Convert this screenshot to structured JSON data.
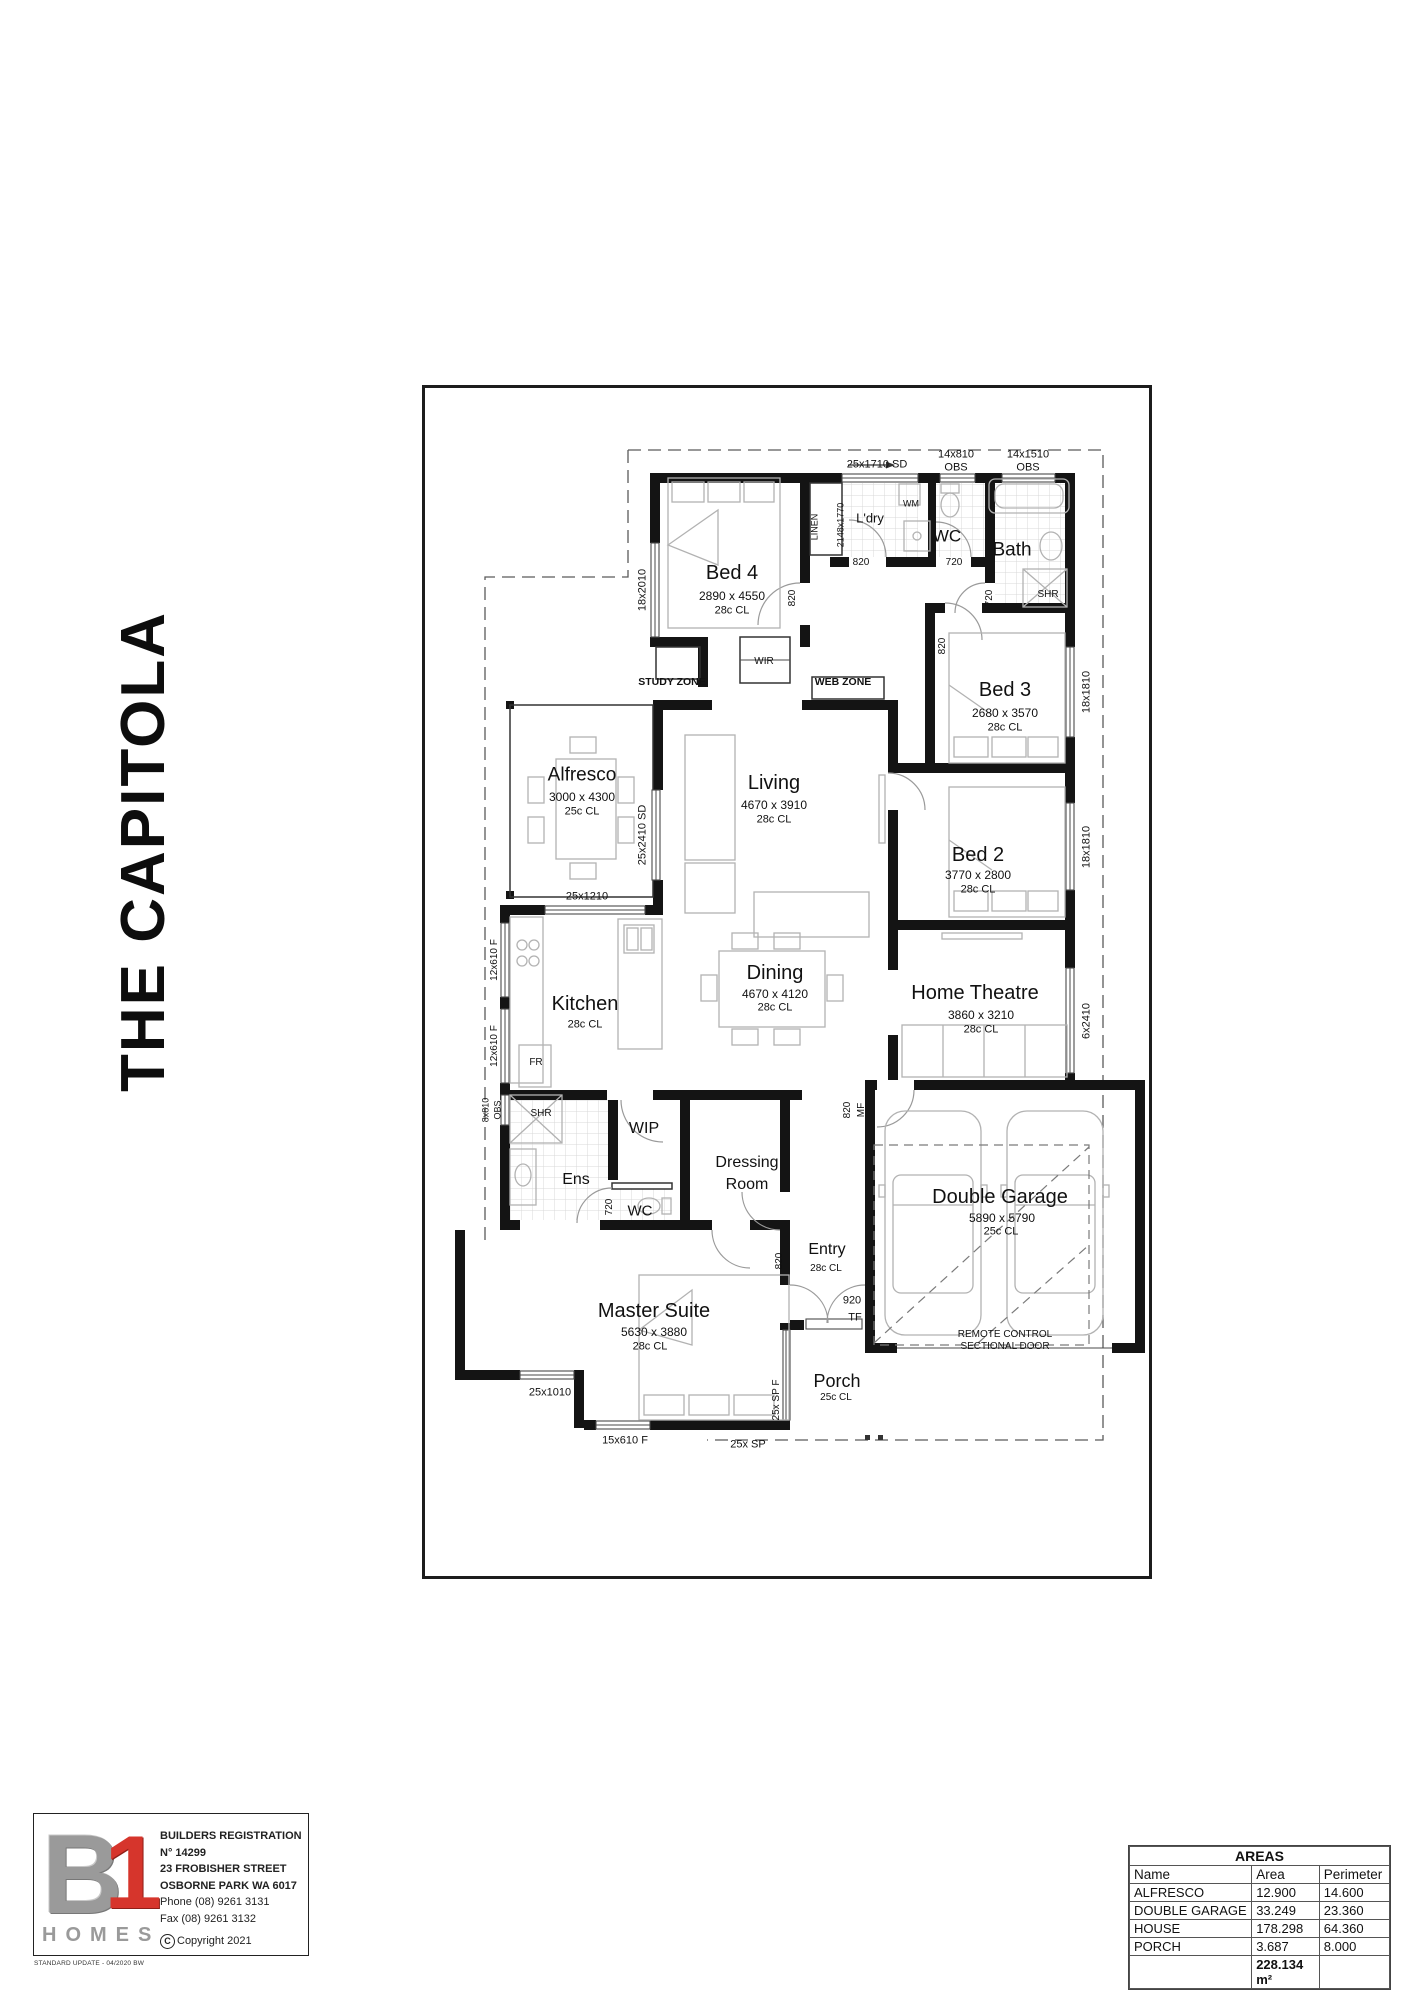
{
  "title": "THE CAPITOLA",
  "plan": {
    "rooms": {
      "bed4": {
        "name": "Bed 4",
        "dims": "2890 x 4550",
        "ceil": "28c CL"
      },
      "ldry": {
        "name": "L'dry"
      },
      "wc_top": {
        "name": "WC"
      },
      "bath": {
        "name": "Bath"
      },
      "bed3": {
        "name": "Bed 3",
        "dims": "2680 x 3570",
        "ceil": "28c CL"
      },
      "bed2": {
        "name": "Bed 2",
        "dims": "3770 x 2800",
        "ceil": "28c CL"
      },
      "theatre": {
        "name": "Home Theatre",
        "dims": "3860 x 3210",
        "ceil": "28c CL"
      },
      "alfresco": {
        "name": "Alfresco",
        "dims": "3000 x 4300",
        "ceil": "25c CL"
      },
      "living": {
        "name": "Living",
        "dims": "4670 x 3910",
        "ceil": "28c CL"
      },
      "kitchen": {
        "name": "Kitchen",
        "ceil": "28c CL"
      },
      "dining": {
        "name": "Dining",
        "dims": "4670 x 4120",
        "ceil": "28c CL"
      },
      "wip": {
        "name": "WIP"
      },
      "ens": {
        "name": "Ens"
      },
      "wc_ens": {
        "name": "WC"
      },
      "dressing": {
        "line1": "Dressing",
        "line2": "Room"
      },
      "entry": {
        "name": "Entry",
        "ceil": "28c CL"
      },
      "master": {
        "name": "Master Suite",
        "dims": "5630 x 3880",
        "ceil": "28c CL"
      },
      "porch": {
        "name": "Porch",
        "ceil": "25c CL"
      },
      "garage": {
        "name": "Double Garage",
        "dims": "5890 x 5790",
        "ceil": "25c CL",
        "note1": "REMOTE CONTROL",
        "note2": "SECTIONAL DOOR"
      }
    },
    "zones": {
      "study": "STUDY ZONE",
      "web": "WEB ZONE",
      "wir": "WIR",
      "linen": "LINEN"
    },
    "fixtures": {
      "wm": "WM",
      "fr": "FR",
      "shr1": "SHR",
      "shr2": "SHR"
    },
    "openings": {
      "sd_top": "25x1710 SD",
      "obs1a": "14x810",
      "obs1b": "OBS",
      "obs2a": "14x1510",
      "obs2b": "OBS",
      "w_bed4": "18x2010",
      "ldry_dim": "2148x1770",
      "d_bed4": "820",
      "d_ldry": "820",
      "d_wc": "720",
      "d_bath": "720",
      "d_bed3": "820",
      "w_bed3": "18x1810",
      "w_bed2": "18x1810",
      "w_theatre": "6x2410",
      "sd_alfresco": "25x2410 SD",
      "w_kitchen": "25x1210",
      "w_k1": "12x610 F",
      "w_k2": "12x610 F",
      "obs3a": "8x810",
      "obs3b": "OBS",
      "d_wcens": "720",
      "d_entry": "820",
      "tf1": "920",
      "tf2": "TF",
      "mf1": "820",
      "mf2": "MF",
      "w_master": "25x1010",
      "w_mbed": "15x610 F",
      "sp": "25x SP",
      "spf": "25x SP F"
    }
  },
  "logo": {
    "letter_b": "B",
    "letter_1": "1",
    "homes": "HOMES",
    "reg1": "BUILDERS REGISTRATION",
    "reg2": "N° 14299",
    "addr1": "23 FROBISHER STREET",
    "addr2": "OSBORNE PARK WA 6017",
    "phone": "Phone (08) 9261 3131",
    "fax": "Fax (08) 9261 3132",
    "copyright_c": "C",
    "copyright": "Copyright 2021",
    "footnote": "STANDARD UPDATE - 04/2020 BW"
  },
  "areas": {
    "title": "AREAS",
    "col_name": "Name",
    "col_area": "Area",
    "col_perimeter": "Perimeter",
    "rows": [
      {
        "name": "ALFRESCO",
        "area": "12.900",
        "perimeter": "14.600"
      },
      {
        "name": "DOUBLE GARAGE",
        "area": "33.249",
        "perimeter": "23.360"
      },
      {
        "name": "HOUSE",
        "area": "178.298",
        "perimeter": "64.360"
      },
      {
        "name": "PORCH",
        "area": "3.687",
        "perimeter": "8.000"
      }
    ],
    "total": "228.134 m²"
  },
  "colors": {
    "wall": "#141414",
    "accent_red": "#d6352c",
    "logo_gray": "#9a9a9a"
  }
}
